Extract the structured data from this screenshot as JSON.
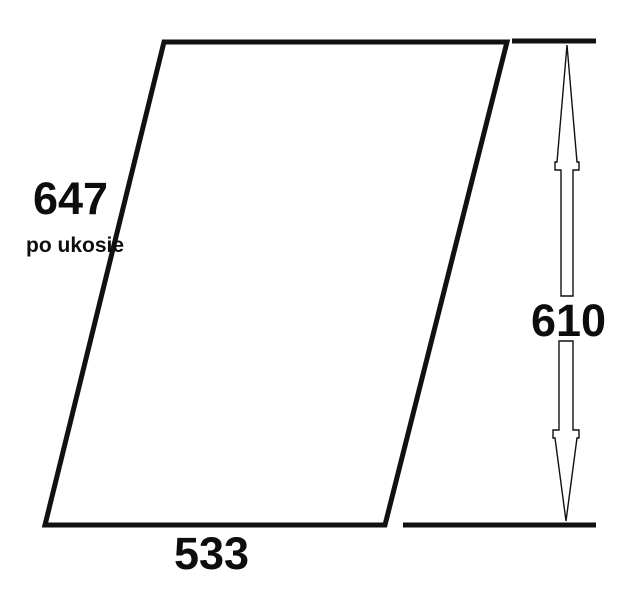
{
  "diagram": {
    "type": "panel-dimension-drawing",
    "shape": "parallelogram",
    "slant_dimension": {
      "value": "647",
      "qualifier": "po ukosie"
    },
    "height_dimension": {
      "value": "610"
    },
    "width_dimension": {
      "value": "533"
    },
    "colors": {
      "background": "#ffffff",
      "line": "#111111",
      "text": "#0d0d0d"
    }
  }
}
